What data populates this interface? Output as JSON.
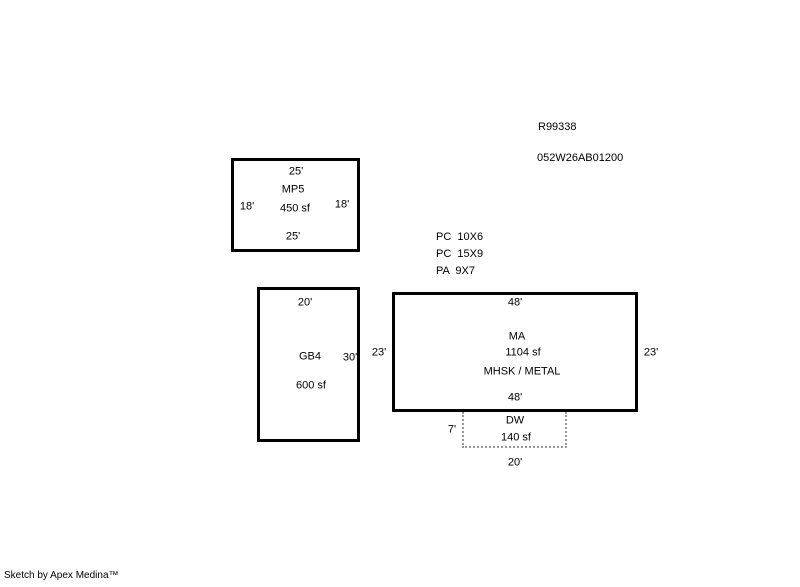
{
  "header": {
    "record_number": "R99338",
    "parcel_id": "052W26AB01200"
  },
  "accessories": {
    "items": [
      {
        "label": "PC  10X6"
      },
      {
        "label": "PC  15X9"
      },
      {
        "label": "PA  9X7"
      }
    ]
  },
  "buildings": {
    "mp5": {
      "code": "MP5",
      "area": "450 sf",
      "dim_top": "25'",
      "dim_bottom": "25'",
      "dim_left": "18'",
      "dim_right": "18'"
    },
    "gb4": {
      "code": "GB4",
      "area": "600 sf",
      "dim_top": "20'",
      "dim_right": "30'"
    },
    "ma": {
      "code": "MA",
      "area": "1104 sf",
      "construction": "MHSK / METAL",
      "dim_top": "48'",
      "dim_bottom": "48'",
      "dim_left": "23'",
      "dim_right": "23'"
    },
    "dw": {
      "code": "DW",
      "area": "140 sf",
      "dim_left": "7'",
      "dim_bottom": "20'"
    }
  },
  "footer": {
    "credit": "Sketch by Apex Medina™"
  },
  "colors": {
    "background": "#FFFFFF",
    "solid_outline": "#000000",
    "dashed_outline": "#999999",
    "text": "#000000"
  }
}
